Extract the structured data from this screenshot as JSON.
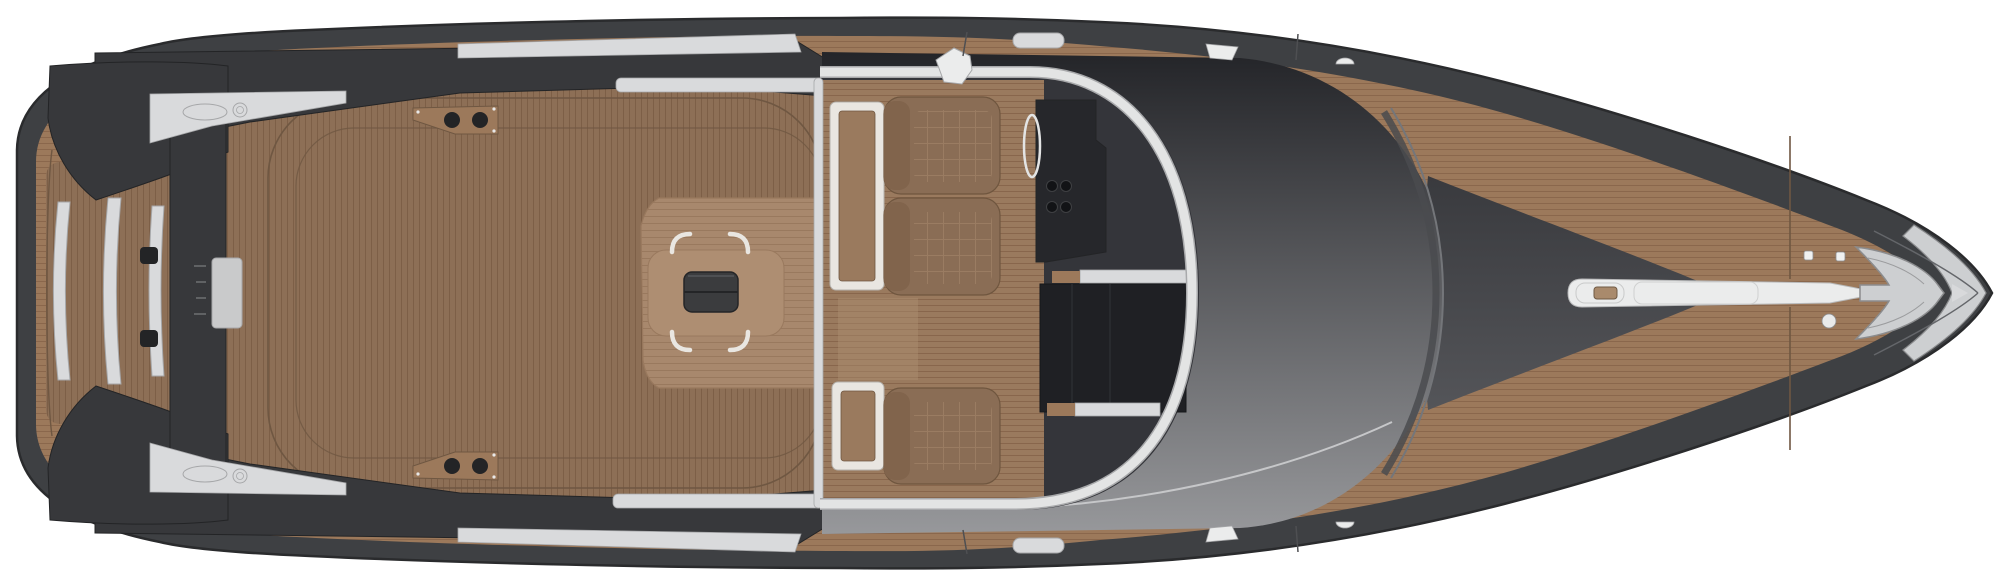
{
  "scene": {
    "kind": "yacht-deck-plan-top-view",
    "background": "#ffffff",
    "canvas": {
      "width": 2000,
      "height": 584
    }
  },
  "colors": {
    "background": "#ffffff",
    "hull": "#3e4043",
    "hull_outline": "#2a2b2d",
    "deck_teak": "#9c795b",
    "deck_teak_line": "#8a674c",
    "aft_teak": "#8d6f56",
    "aft_teak_line": "#7d5f47",
    "stern_dark": "#37383b",
    "stern_dark_edge": "#232426",
    "silver": "#d9dadc",
    "silver_edge": "#a6a7a9",
    "steel_patch": "#c9cacb",
    "white_trim": "#e9e6e1",
    "trim_edge": "#b5b2ad",
    "sunpad": "#a8886d",
    "sunpad_line": "#99795e",
    "sunpad_center": "#ae8e72",
    "table": "#3b3c3e",
    "table_seam": "#242527",
    "cushion": "#8a6d55",
    "cushion_dark": "#81644c",
    "cushion_line": "#9a7c62",
    "cushion_edge": "#6f563f",
    "cockpit_floor": "#9a7a5e",
    "cockpit_floor_line": "#88664c",
    "interior_dark": "#34353a",
    "console": "#26272b",
    "companionway": "#1f2024",
    "knob": "#121316",
    "windshield_frame": "#e3e4e4",
    "frame_casing": "#a8a9ab",
    "roof_top": "#232428",
    "roof_bottom": "#97989b",
    "roof_edge_band": "#4a4b4f",
    "roof_edge_light": "#74767a",
    "skylight_top": "#393a3e",
    "skylight_bottom": "#545559",
    "anchor_metal": "#cdcfd1",
    "anchor_edge": "#8b8c8e",
    "bow_strip": "#ebecec",
    "bow_strip_edge": "#b8b9ba",
    "hatch_detail_brown": "#a98a6c",
    "seam": "#6f5742",
    "seam_dark": "#4e4f52",
    "tick": "#6f7072"
  }
}
